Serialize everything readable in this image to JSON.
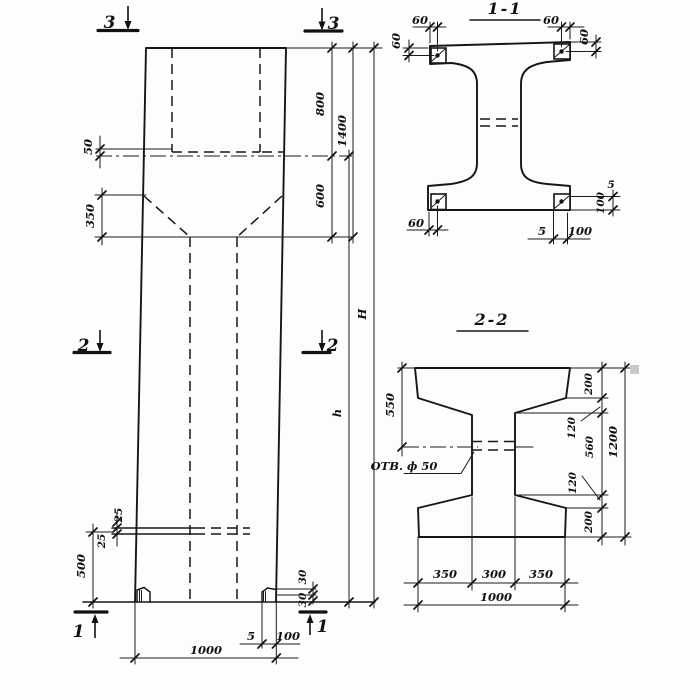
{
  "elevation": {
    "section_markers": {
      "top_left": "3",
      "top_right": "3",
      "middle_left": "2",
      "middle_right": "2",
      "bottom_left": "1",
      "bottom_right": "1"
    },
    "dimensions": {
      "recess_offset": "50",
      "taper_height": "350",
      "top_block_height": "800",
      "upper_total": "1400",
      "transition_height": "600",
      "overall_height": "H",
      "shaft_height": "h",
      "plate_upper": "25",
      "plate_lower": "25",
      "lower_zone": "500",
      "foot_lip_upper": "30",
      "foot_lip_lower": "30",
      "shoe_thickness": "5",
      "foot_width": "100",
      "column_width": "1000"
    }
  },
  "section_1_1": {
    "title": "1-1",
    "dimensions": {
      "anchor_left_offset": "60",
      "anchor_left_depth": "60",
      "anchor_right_offset": "60",
      "anchor_right_depth": "60",
      "anchor_bottom_offset": "60",
      "shoe_thickness_bottom": "5",
      "shoe_width_bottom": "100",
      "shoe_thickness_right": "5",
      "shoe_height_right": "100"
    }
  },
  "section_2_2": {
    "title": "2-2",
    "hole_label": "ОТВ. ф 50",
    "dimensions": {
      "top_to_hole": "550",
      "flange_top": "200",
      "haunch_top": "120",
      "web_height": "560",
      "haunch_bottom": "120",
      "flange_bottom": "200",
      "section_height": "1200",
      "bottom_left": "350",
      "bottom_web": "300",
      "bottom_right": "350",
      "bottom_total": "1000"
    }
  }
}
